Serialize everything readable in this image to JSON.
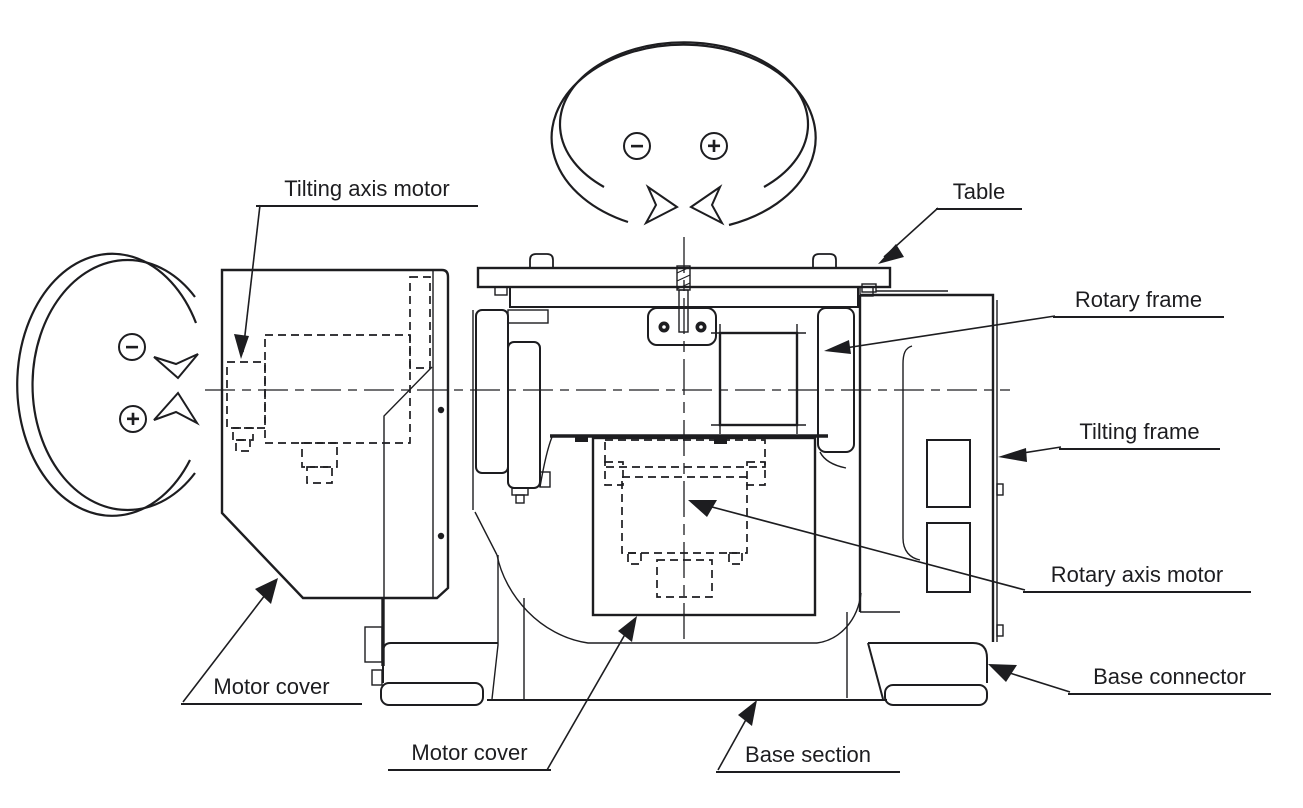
{
  "labels": {
    "tilting_axis_motor": "Tilting axis motor",
    "table": "Table",
    "rotary_frame": "Rotary frame",
    "tilting_frame": "Tilting frame",
    "rotary_axis_motor": "Rotary axis motor",
    "base_connector": "Base connector",
    "motor_cover_left": "Motor cover",
    "motor_cover_bottom": "Motor cover",
    "base_section": "Base section"
  },
  "rotation_indicators": {
    "rotary_axis_top": {
      "minus": "−",
      "plus": "+"
    },
    "tilting_axis_left": {
      "minus": "−",
      "plus": "+"
    }
  },
  "colors": {
    "line": "#1d1d20",
    "text": "#1d1d20",
    "background": "#ffffff"
  }
}
